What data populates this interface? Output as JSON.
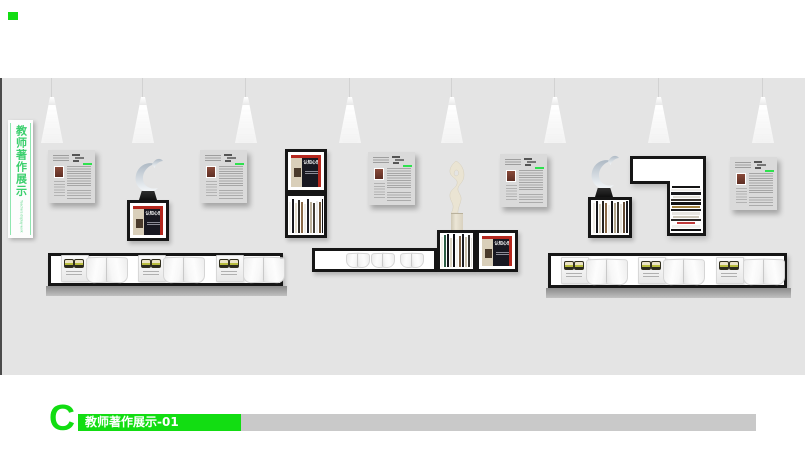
{
  "sign": {
    "title_cn": "教师著作展示",
    "title_en": "Teachers display work"
  },
  "cover": {
    "title": "认知心理学"
  },
  "footer": {
    "letter": "C",
    "label": "教师著作展示-01"
  },
  "colors": {
    "accent_green": "#12dd12",
    "sign_green": "#3bcf6d",
    "wall": "#e4e4e4",
    "frame_black": "#161616",
    "cover_red": "#b5281e",
    "cover_dark": "#181821",
    "cover_beige": "#d9cfba",
    "poster_bg": "#dadada",
    "footer_gray": "#c9c9c9"
  },
  "lights": {
    "x": [
      52,
      143,
      246,
      350,
      452,
      555,
      659,
      763
    ]
  },
  "posters": {
    "positions": [
      [
        48,
        150
      ],
      [
        200,
        150
      ],
      [
        368,
        152
      ],
      [
        500,
        154
      ],
      [
        730,
        157
      ]
    ]
  },
  "shelves": {
    "left": {
      "x": 48,
      "y": 253,
      "w": 235,
      "h": 33,
      "books_x": [
        10,
        87,
        165
      ],
      "opens_x": [
        35,
        112,
        192
      ]
    },
    "right": {
      "x": 548,
      "y": 253,
      "w": 239,
      "h": 35,
      "books_x": [
        10,
        87,
        165
      ],
      "opens_x": [
        35,
        112,
        192
      ]
    },
    "middle_opens_x": [
      31,
      56,
      85
    ]
  },
  "spine_sets": {
    "column": [
      {
        "c": "#f4f2ec",
        "h": 31
      },
      {
        "c": "#17171c",
        "h": 34
      },
      {
        "c": "#e6dfcf",
        "h": 30
      },
      {
        "c": "#2e2a25",
        "h": 33
      },
      {
        "c": "#8a6a48",
        "h": 31
      },
      {
        "c": "#f0eee8",
        "h": 29
      },
      {
        "c": "#1d1d24",
        "h": 34
      },
      {
        "c": "#bdb29c",
        "h": 31
      },
      {
        "c": "#423c33",
        "h": 30
      },
      {
        "c": "#ebebe9",
        "h": 32
      },
      {
        "c": "#6e5335",
        "h": 31
      },
      {
        "c": "#111114",
        "h": 34
      }
    ],
    "middle": [
      {
        "c": "#f2f0ea",
        "h": 30
      },
      {
        "c": "#2c5e46",
        "h": 32
      },
      {
        "c": "#14141a",
        "h": 33
      },
      {
        "c": "#ddd6c4",
        "h": 29
      },
      {
        "c": "#101013",
        "h": 33
      },
      {
        "c": "#f5f4f0",
        "h": 28
      },
      {
        "c": "#7c5f41",
        "h": 31
      },
      {
        "c": "#1b1b20",
        "h": 33
      },
      {
        "c": "#c9c0ad",
        "h": 30
      },
      {
        "c": "#33302b",
        "h": 32
      },
      {
        "c": "#e8e6e0",
        "h": 29
      }
    ],
    "swan": [
      {
        "c": "#efece6",
        "h": 30
      },
      {
        "c": "#16161a",
        "h": 33
      },
      {
        "c": "#d9d2c0",
        "h": 29
      },
      {
        "c": "#24211d",
        "h": 32
      },
      {
        "c": "#8a6a48",
        "h": 30
      },
      {
        "c": "#f3f1ec",
        "h": 28
      },
      {
        "c": "#101014",
        "h": 33
      },
      {
        "c": "#b4a88f",
        "h": 30
      },
      {
        "c": "#3c362e",
        "h": 31
      },
      {
        "c": "#e7e4dd",
        "h": 29
      },
      {
        "c": "#5f4832",
        "h": 31
      },
      {
        "c": "#191920",
        "h": 33
      }
    ]
  },
  "flat_rows": [
    {
      "c": "#141414",
      "w": 94
    },
    {
      "c": "#efede9",
      "w": 97
    },
    {
      "c": "#1c1c1e",
      "w": 99
    },
    {
      "c": "#e3e0d8",
      "w": 90
    },
    {
      "c": "#35302a",
      "w": 97
    },
    {
      "c": "#111113",
      "w": 99
    },
    {
      "c": "#a3823f",
      "w": 95
    },
    {
      "c": "#1b1b1d",
      "w": 99
    },
    {
      "c": "#e9e7e2",
      "w": 96
    },
    {
      "c": "#cfc9bc",
      "w": 88
    },
    {
      "c": "#2b2927",
      "w": 97
    },
    {
      "c": "#bf3a3a",
      "w": 58
    },
    {
      "c": "#f1f0ed",
      "w": 93
    },
    {
      "c": "#0f0f11",
      "w": 99
    }
  ]
}
